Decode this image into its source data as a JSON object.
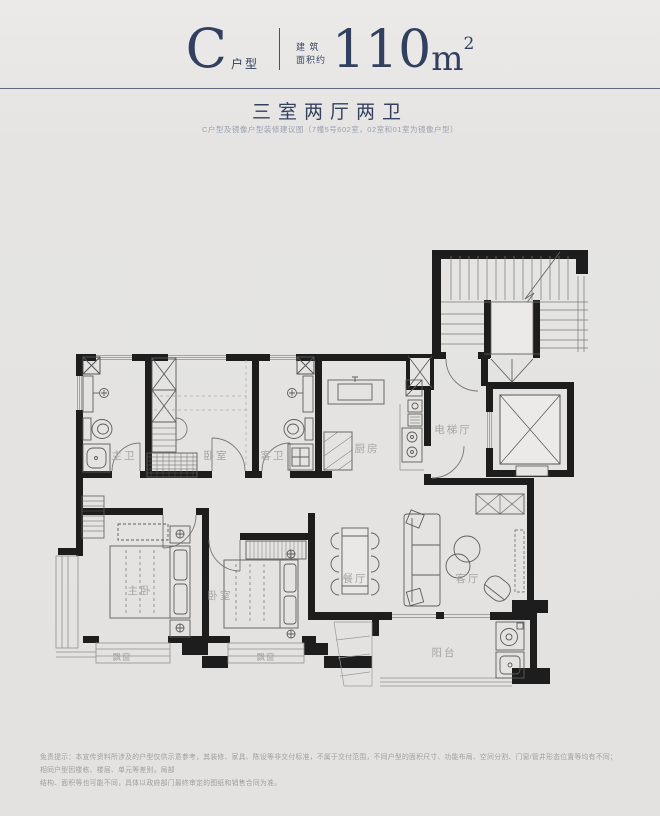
{
  "header": {
    "type_letter": "C",
    "type_label": "户型",
    "area_label_line1": "建 筑",
    "area_label_line2": "面积约",
    "area_number": "110",
    "area_unit": "m",
    "area_exponent": "2"
  },
  "section": {
    "title": "三室两厅两卫",
    "note": "C户型及镜像户型装修建议图（7幢5号602室，02室和01室为镜像户型）"
  },
  "plan": {
    "rooms": {
      "master_bath": "主卫",
      "bedroom_top": "卧室",
      "guest_bath": "客卫",
      "kitchen": "厨房",
      "elevator_hall": "电梯厅",
      "master_bedroom": "主卧",
      "bedroom_second": "卧室",
      "dining_room": "餐厅",
      "living_room": "客厅",
      "balcony": "阳台",
      "bay_window_left": "飘窗",
      "bay_window_right": "飘窗"
    }
  },
  "footer": {
    "line1": "免责提示：本宣传资料所涉及的户型仅供示意参考，其装修、家具、陈设等非交付标准，不属于交付范围，不同户型的面积尺寸、功能布局、空间分割、门窗/管井形态位置等均有不同；相同户型因楼栋、楼层、单元等差别，局部",
    "line2": "结构、面积等也可能不同，具体以政府部门最终审定的图纸和销售合同为准。"
  },
  "colors": {
    "background": "#e4e3e1",
    "navy": "#31405f",
    "wall": "#1d1d1d",
    "room_label": "#a5a5a5",
    "note_text": "#99a1b1",
    "disclaimer_text": "#9e9e9e"
  }
}
